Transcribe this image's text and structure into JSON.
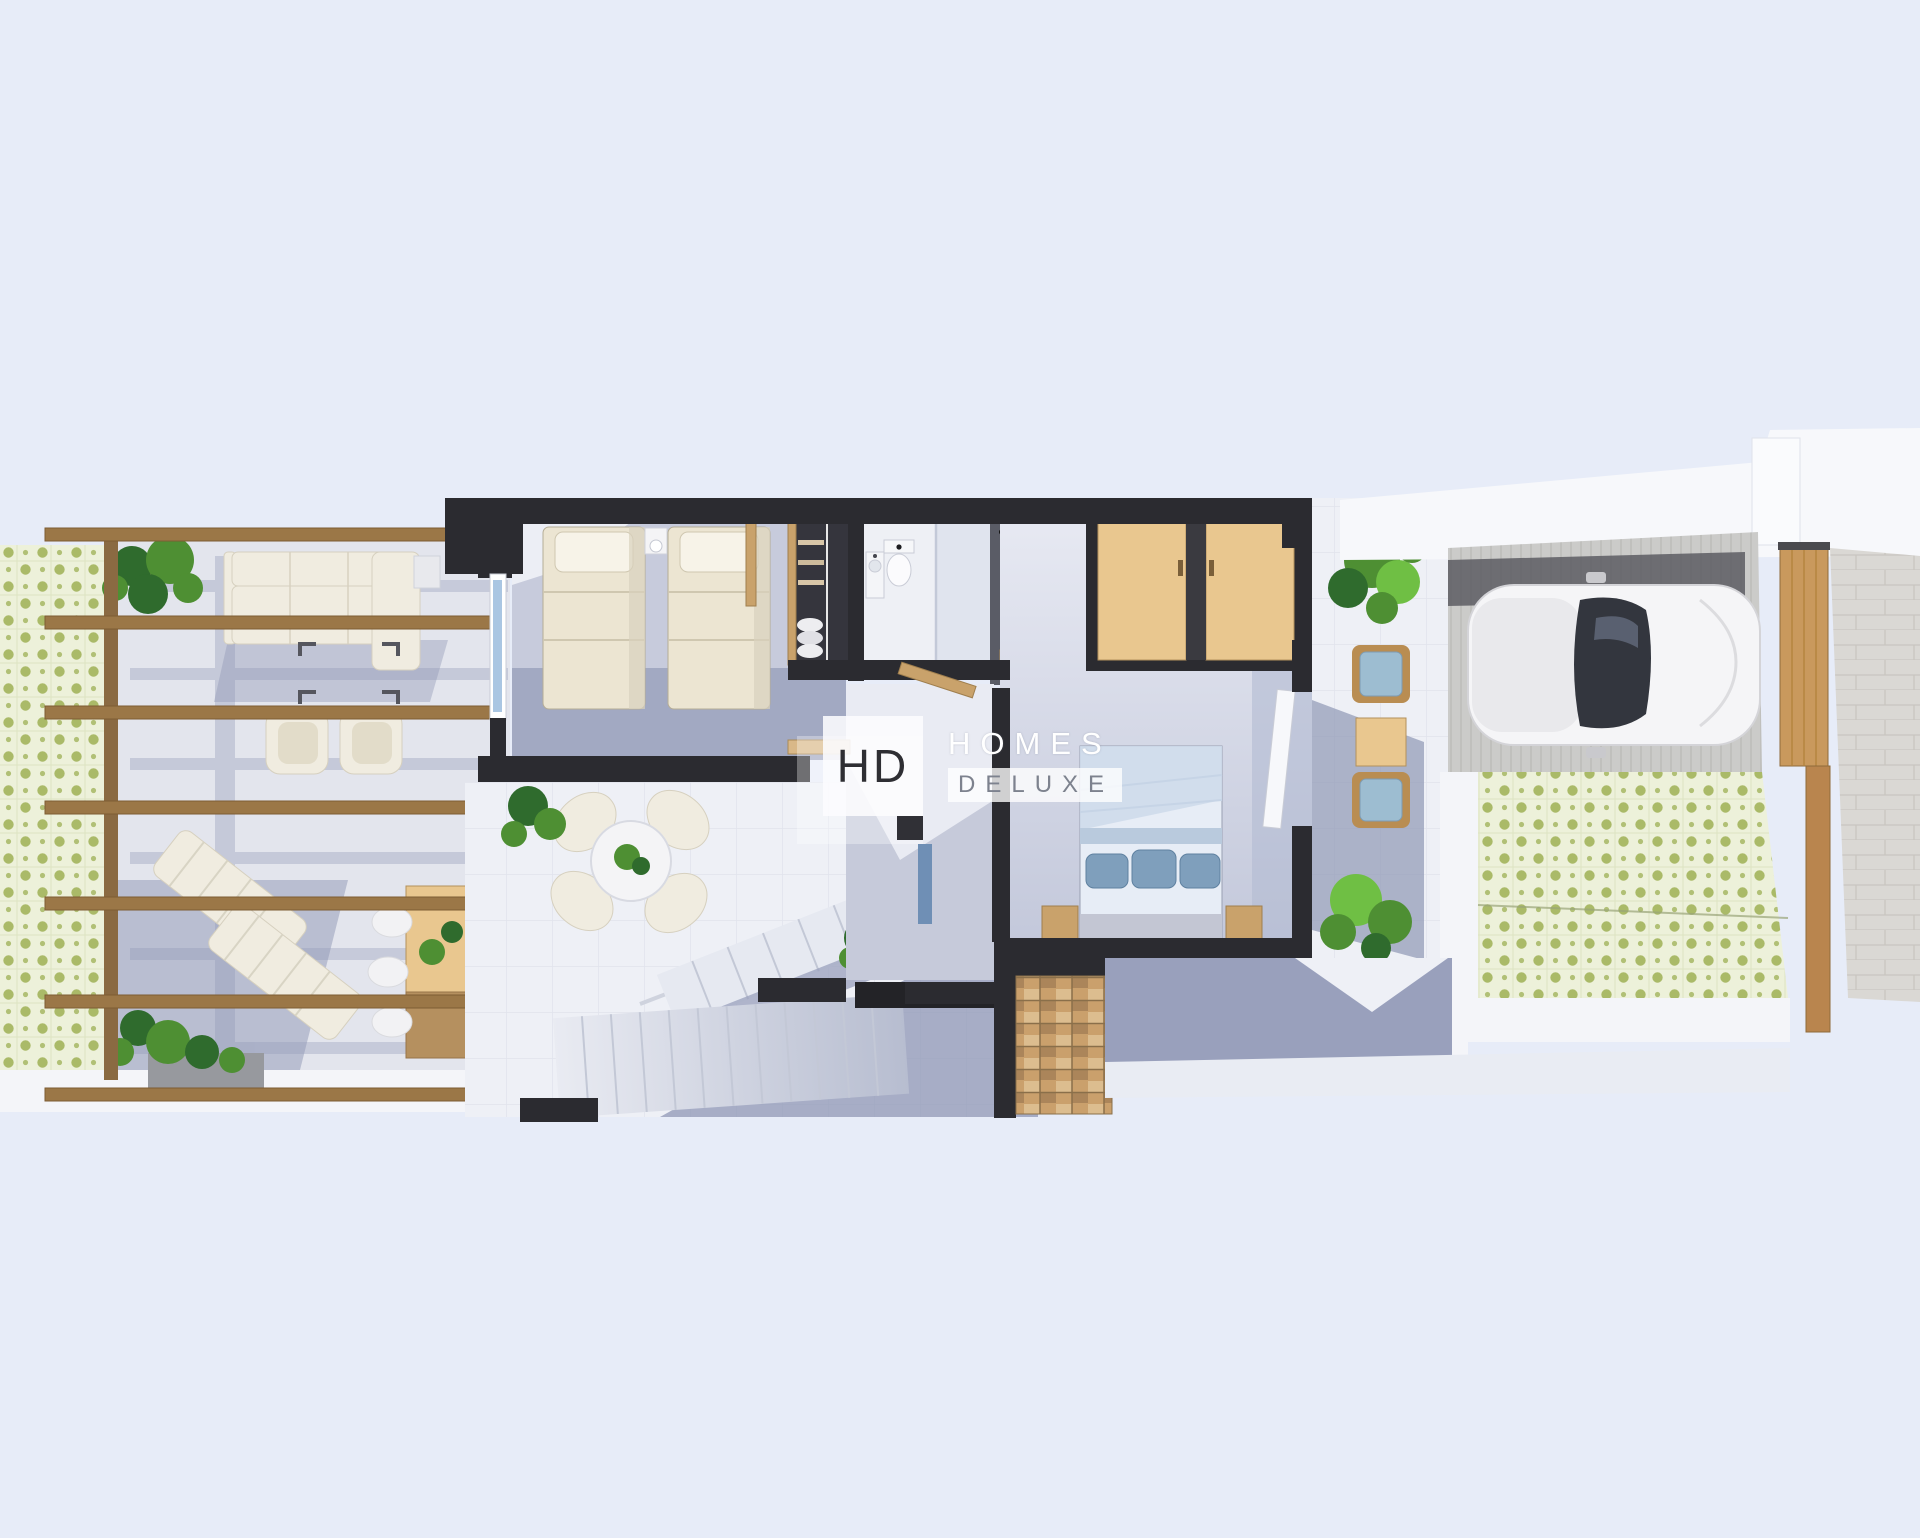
{
  "app": {
    "type": "3d-floorplan-render"
  },
  "logo": {
    "monogram": "HD",
    "name_top": "HOMES",
    "name_bottom": "DELUXE"
  },
  "colors": {
    "background": "#e7ecf8",
    "wall-dark": "#2b2b30",
    "floor-light": "#eef0f6",
    "floor-lavender": "#c7cbdc",
    "carpet-shadow": "#99a0bc",
    "shadow-blue": "#8f97b5",
    "tile-base": "#edf1da",
    "tile-dot": "#a3b45c",
    "wood-beam": "#9b7747",
    "wood-light": "#e9c78f",
    "wood-mid": "#c9a26b",
    "cream": "#f0ece0",
    "plant-dark": "#2f6b2d",
    "plant-mid": "#4e8f33",
    "plant-light": "#6fbf44",
    "car-white": "#f5f5f7",
    "concrete": "#cbcbc9",
    "brick": "#dad8d4",
    "gate-wood": "#c9995d",
    "cushion-blue": "#9dbdd1",
    "pillow-blue": "#7f9fbc",
    "duvet-blue": "#ccd9ea",
    "logo-dark": "#2e2e33",
    "logo-gray": "#7d828e"
  },
  "scene": {
    "regions": [
      "pergola terrace with green patterned tiles",
      "outdoor lounge sofa and armchairs",
      "two sun loungers",
      "outdoor dining table with chairs and plants",
      "twin bedroom with two single beds",
      "open wardrobe closet",
      "bathroom with toilet, sink and shower",
      "dressing area with ceiling fan and desk",
      "master bedroom with double bed and wooden wardrobes",
      "roof terrace with round table and four chairs",
      "white staircase flights",
      "wooden slatted steps",
      "side terrace with two chairs, table and plants",
      "driveway with white car",
      "green tiled drive and wooden garden gate",
      "stone boundary wall"
    ]
  }
}
